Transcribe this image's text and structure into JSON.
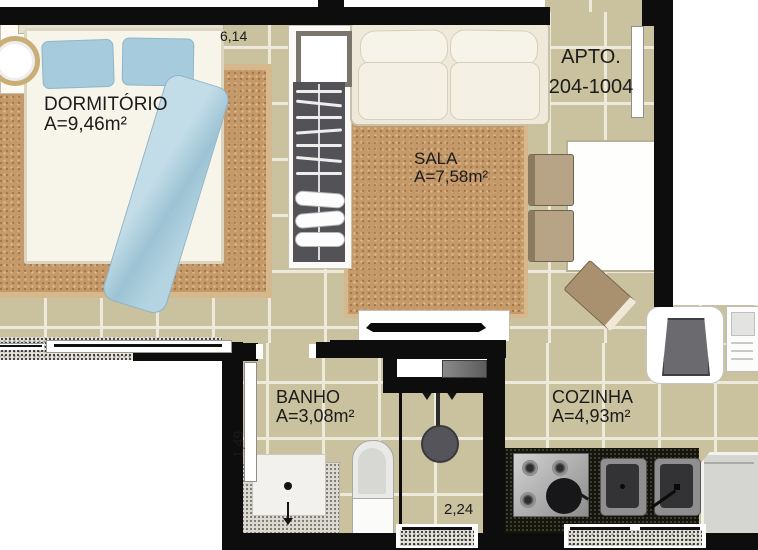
{
  "plan": {
    "apartment": {
      "line1": "APTO.",
      "line2": "204-1004"
    },
    "rooms": {
      "dormitorio": {
        "name": "DORMITÓRIO",
        "area": "A=9,46m²"
      },
      "sala": {
        "name": "SALA",
        "area": "A=7,58m²"
      },
      "banho": {
        "name": "BANHO",
        "area": "A=3,08m²"
      },
      "cozinha": {
        "name": "COZINHA",
        "area": "A=4,93m²"
      }
    },
    "dimensions": {
      "top_width": "6,14",
      "banho_height": "1,49",
      "banho_width": "2,24"
    },
    "colors": {
      "wall": "#0d0d0d",
      "floor_tile": "#cac19e",
      "grout": "#eeeadb",
      "rug": "#c59a6b",
      "pillow_blue": "#a5cbdc",
      "blanket_blue": "#b4d4e2",
      "counter_granite": "#15150d",
      "closet_interior": "#525257",
      "text": "#1b1b1b"
    }
  }
}
